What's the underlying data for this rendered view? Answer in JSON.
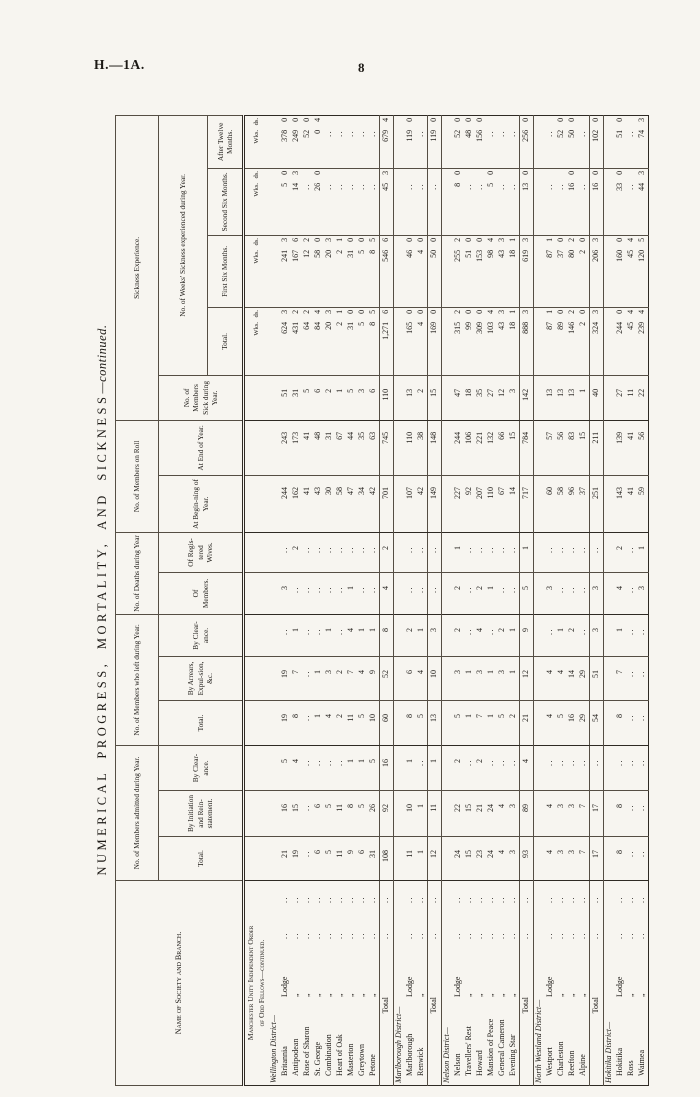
{
  "page": {
    "doc_ref": "H.—1A.",
    "page_number": "8"
  },
  "title": {
    "main": "NUMERICAL PROGRESS, MORTALITY, AND SICKNESS",
    "cont": "—continued."
  },
  "table": {
    "header": {
      "name": "Name of Society and Branch.",
      "groups": [
        {
          "label": "No. of Members admitted during Year.",
          "cols": [
            "Total.",
            "By Initiation and Rein-statement.",
            "By Clear-ance."
          ]
        },
        {
          "label": "No. of Members who left during Year.",
          "cols": [
            "Total.",
            "By Arrears, Expul-sion, &c.",
            "By Clear-ance."
          ]
        },
        {
          "label": "No. of Deaths during Year",
          "cols": [
            "Of Members.",
            "Of Regis-tered Wives."
          ]
        },
        {
          "label": "No. of Members on Roll",
          "cols": [
            "At Begin-ning of Year.",
            "At End of Year."
          ]
        },
        {
          "label": "Sickness Experience.",
          "members_sick": "No. of Members Sick during Year.",
          "sub": "No. of Weeks' Sickness experienced during Year.",
          "cols": [
            "Total.",
            "First Six Months.",
            "Second Six Months.",
            "After Twelve Months."
          ]
        }
      ],
      "units": {
        "wks": "Wks.",
        "ds": "ds."
      }
    },
    "heading": [
      "Manchester Unity Independent Order",
      "of Odd Fellows—continued."
    ],
    "rows": [
      {
        "t": "u"
      },
      {
        "t": "d",
        "n": "Wellington District—"
      },
      {
        "t": "l",
        "n": "Britannia",
        "s": "Lodge",
        "v": [
          "21",
          "16",
          "5",
          "19",
          "19",
          "..",
          "3",
          "..",
          "244",
          "243",
          "51",
          "624|3",
          "241|3",
          "5|0",
          "378|0"
        ]
      },
      {
        "t": "l",
        "n": "Antipodean",
        "s": "„",
        "v": [
          "19",
          "15",
          "4",
          "8",
          "7",
          "1",
          "..",
          "2",
          "162",
          "173",
          "31",
          "431|2",
          "167|6",
          "14|3",
          "249|0"
        ]
      },
      {
        "t": "l",
        "n": "Rose of Sharon",
        "s": "„",
        "v": [
          "..",
          "..",
          "..",
          "..",
          "..",
          "..",
          "..",
          "..",
          "41",
          "41",
          "5",
          "64|2",
          "12|2",
          "..",
          "52|0"
        ]
      },
      {
        "t": "l",
        "n": "St. George",
        "s": "„",
        "v": [
          "6",
          "6",
          "..",
          "1",
          "1",
          "..",
          "..",
          "..",
          "43",
          "48",
          "6",
          "84|4",
          "58|0",
          "26|0",
          "0|4"
        ]
      },
      {
        "t": "l",
        "n": "Combination",
        "s": "„",
        "v": [
          "5",
          "5",
          "..",
          "4",
          "3",
          "1",
          "..",
          "..",
          "30",
          "31",
          "2",
          "20|3",
          "20|3",
          "..",
          ".."
        ]
      },
      {
        "t": "l",
        "n": "Heart of Oak",
        "s": "„",
        "v": [
          "11",
          "11",
          "..",
          "2",
          "2",
          "..",
          "..",
          "..",
          "58",
          "67",
          "1",
          "2|1",
          "2|1",
          "..",
          ".."
        ]
      },
      {
        "t": "l",
        "n": "Masterton",
        "s": "„",
        "v": [
          "9",
          "8",
          "1",
          "11",
          "7",
          "4",
          "1",
          "..",
          "47",
          "44",
          "5",
          "31|0",
          "31|0",
          "..",
          ".."
        ]
      },
      {
        "t": "l",
        "n": "Greytown",
        "s": "„",
        "v": [
          "6",
          "5",
          "1",
          "5",
          "4",
          "1",
          "..",
          "..",
          "34",
          "35",
          "3",
          "5|0",
          "5|0",
          "..",
          ".."
        ]
      },
      {
        "t": "l",
        "n": "Petone",
        "s": "„",
        "v": [
          "31",
          "26",
          "5",
          "10",
          "9",
          "1",
          "..",
          "..",
          "42",
          "63",
          "6",
          "8|5",
          "8|5",
          "..",
          ".."
        ]
      },
      {
        "t": "t",
        "n": "Total",
        "v": [
          "108",
          "92",
          "16",
          "60",
          "52",
          "8",
          "4",
          "2",
          "701",
          "745",
          "110",
          "1,271|6",
          "546|6",
          "45|3",
          "679|4"
        ]
      },
      {
        "t": "d",
        "n": "Marlborough District—"
      },
      {
        "t": "l",
        "n": "Marlborough",
        "s": "Lodge",
        "v": [
          "11",
          "10",
          "1",
          "8",
          "6",
          "2",
          "..",
          "..",
          "107",
          "110",
          "13",
          "165|0",
          "46|0",
          "..",
          "119|0"
        ]
      },
      {
        "t": "l",
        "n": "Renwick",
        "s": "„",
        "v": [
          "1",
          "1",
          "..",
          "5",
          "4",
          "1",
          "..",
          "..",
          "42",
          "38",
          "2",
          "4|0",
          "4|0",
          "..",
          ".."
        ]
      },
      {
        "t": "t",
        "n": "Total",
        "v": [
          "12",
          "11",
          "1",
          "13",
          "10",
          "3",
          "..",
          "..",
          "149",
          "148",
          "15",
          "169|0",
          "50|0",
          "..",
          "119|0"
        ]
      },
      {
        "t": "d",
        "n": "Nelson District—"
      },
      {
        "t": "l",
        "n": "Nelson",
        "s": "Lodge",
        "v": [
          "24",
          "22",
          "2",
          "5",
          "3",
          "2",
          "2",
          "1",
          "227",
          "244",
          "47",
          "315|2",
          "255|2",
          "8|0",
          "52|0"
        ]
      },
      {
        "t": "l",
        "n": "Travellers' Rest",
        "s": "„",
        "v": [
          "15",
          "15",
          "..",
          "1",
          "1",
          "..",
          "..",
          "..",
          "92",
          "106",
          "18",
          "99|0",
          "51|0",
          "..",
          "48|0"
        ]
      },
      {
        "t": "l",
        "n": "Howard",
        "s": "„",
        "v": [
          "23",
          "21",
          "2",
          "7",
          "3",
          "4",
          "2",
          "..",
          "207",
          "221",
          "35",
          "309|0",
          "153|0",
          "..",
          "156|0"
        ]
      },
      {
        "t": "l",
        "n": "Mansion of Peace",
        "s": "„",
        "v": [
          "24",
          "24",
          "..",
          "1",
          "1",
          "..",
          "1",
          "..",
          "110",
          "132",
          "27",
          "103|4",
          "98|4",
          "5|0",
          ".."
        ]
      },
      {
        "t": "l",
        "n": "General Cameron",
        "s": "„",
        "v": [
          "4",
          "4",
          "..",
          "5",
          "3",
          "2",
          "..",
          "..",
          "67",
          "66",
          "12",
          "43|3",
          "43|3",
          "..",
          ".."
        ]
      },
      {
        "t": "l",
        "n": "Evening Star",
        "s": "„",
        "v": [
          "3",
          "3",
          "..",
          "2",
          "1",
          "1",
          "..",
          "..",
          "14",
          "15",
          "3",
          "18|1",
          "18|1",
          "..",
          ".."
        ]
      },
      {
        "t": "t",
        "n": "Total",
        "v": [
          "93",
          "89",
          "4",
          "21",
          "12",
          "9",
          "5",
          "1",
          "717",
          "784",
          "142",
          "888|3",
          "619|3",
          "13|0",
          "256|0"
        ]
      },
      {
        "t": "d",
        "n": "North Westland District—"
      },
      {
        "t": "l",
        "n": "Westport",
        "s": "Lodge",
        "v": [
          "4",
          "4",
          "..",
          "4",
          "4",
          "..",
          "3",
          "..",
          "60",
          "57",
          "13",
          "87|1",
          "87|1",
          "..",
          ".."
        ]
      },
      {
        "t": "l",
        "n": "Charleston",
        "s": "„",
        "v": [
          "3",
          "3",
          "..",
          "5",
          "4",
          "1",
          "..",
          "..",
          "58",
          "56",
          "13",
          "89|0",
          "37|0",
          "..",
          "52|0"
        ]
      },
      {
        "t": "l",
        "n": "Reefton",
        "s": "„",
        "v": [
          "3",
          "3",
          "..",
          "16",
          "14",
          "2",
          "..",
          "..",
          "96",
          "83",
          "13",
          "146|2",
          "80|2",
          "16|0",
          "50|0"
        ]
      },
      {
        "t": "l",
        "n": "Alpine",
        "s": "„",
        "v": [
          "7",
          "7",
          "..",
          "29",
          "29",
          "..",
          "..",
          "..",
          "37",
          "15",
          "1",
          "2|0",
          "2|0",
          "..",
          ".."
        ]
      },
      {
        "t": "t",
        "n": "Total",
        "v": [
          "17",
          "17",
          "..",
          "54",
          "51",
          "3",
          "3",
          "..",
          "251",
          "211",
          "40",
          "324|3",
          "206|3",
          "16|0",
          "102|0"
        ]
      },
      {
        "t": "d",
        "n": "Hokitika District—"
      },
      {
        "t": "l",
        "n": "Hokitika",
        "s": "Lodge",
        "v": [
          "8",
          "8",
          "..",
          "8",
          "7",
          "1",
          "4",
          "2",
          "143",
          "139",
          "27",
          "244|0",
          "160|0",
          "33|0",
          "51|0"
        ]
      },
      {
        "t": "l",
        "n": "Ross",
        "s": "„",
        "v": [
          "..",
          "..",
          "..",
          "..",
          "..",
          "..",
          "..",
          "..",
          "41",
          "41",
          "11",
          "45|4",
          "45|4",
          "..",
          ".."
        ]
      },
      {
        "t": "l",
        "n": "Waimea",
        "s": "„",
        "v": [
          "..",
          "..",
          "..",
          "..",
          "..",
          "..",
          "3",
          "1",
          "59",
          "56",
          "22",
          "239|4",
          "120|5",
          "44|3",
          "74|3"
        ]
      }
    ]
  }
}
